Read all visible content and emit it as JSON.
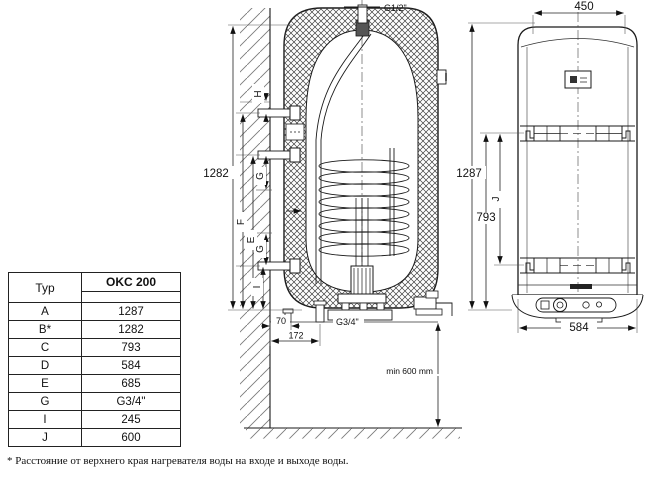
{
  "table": {
    "col_typ": "Typ",
    "col_model": "OKC 200",
    "rows": [
      {
        "param": "A",
        "value": "1287"
      },
      {
        "param": "B*",
        "value": "1282"
      },
      {
        "param": "C",
        "value": "793"
      },
      {
        "param": "D",
        "value": "584"
      },
      {
        "param": "E",
        "value": "685"
      },
      {
        "param": "G",
        "value": "G3/4\""
      },
      {
        "param": "I",
        "value": "245"
      },
      {
        "param": "J",
        "value": "600"
      }
    ]
  },
  "side_view": {
    "top_connection": "G1/2\"",
    "bottom_connection": "G3/4\"",
    "dim_total": "1282",
    "dim_wall_1": "70",
    "dim_wall_2": "172",
    "label_h": "H",
    "label_f": "F",
    "label_e": "E",
    "label_g_upper": "G",
    "label_g_lower": "G",
    "label_i": "I",
    "clearance_note": "min 600 mm"
  },
  "front_view": {
    "dim_width_top": "450",
    "dim_width_bottom": "584",
    "dim_height": "1287",
    "dim_bracket": "793",
    "label_j": "J"
  },
  "footnote": "* Расстояние от верхнего края нагревателя воды на входе и выходе  воды.",
  "colors": {
    "line": "#1a1a1a",
    "thin": "#555",
    "hatch": "#777"
  }
}
